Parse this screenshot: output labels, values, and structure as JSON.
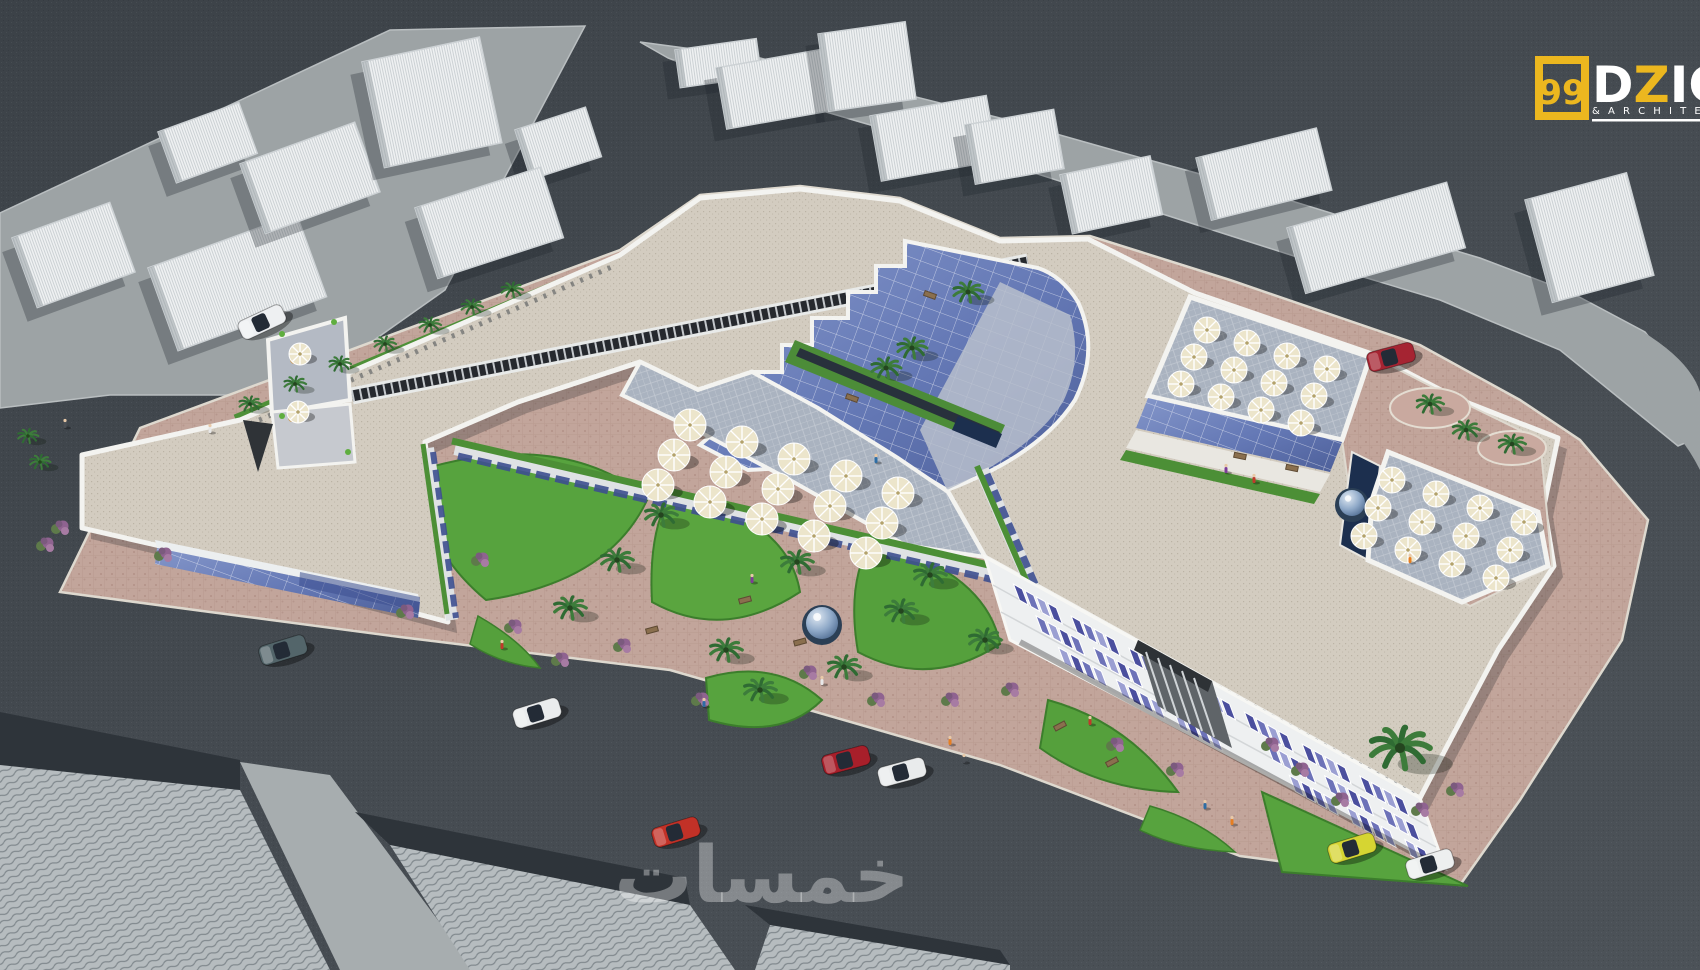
{
  "logo": {
    "number": "99",
    "name_white_1": "D",
    "name_yellow": "Z",
    "name_white_2": "IG",
    "subtitle": "& A R C H I T E",
    "yellow": "#ecb71f",
    "white": "#ffffff"
  },
  "watermark": {
    "text": "خمسات",
    "color": "rgba(255,255,255,0.34)"
  },
  "palette": {
    "road": "#454b51",
    "road_dark": "#383e44",
    "parcel": "#9da3a5",
    "site_paving": "#c2a59b",
    "roof": "#d3ccc0",
    "parapet": "#f3f3f0",
    "glass_hi": "#7d90c4",
    "glass_lo": "#55679f",
    "lawn": "#57a33e",
    "hedge": "#4c8f36",
    "pool": "#1c2f4e",
    "terrace_paving": "#aab3c0",
    "facade": "#eef0f1",
    "window_blue": "#4b4f9e",
    "umbrella": "#ece5cb",
    "skylight": "#23262b"
  },
  "scene": {
    "context_blocks_p1": [
      {
        "x": 12,
        "y": 238,
        "w": 104,
        "h": 74,
        "r": -20
      },
      {
        "x": 148,
        "y": 268,
        "w": 158,
        "h": 88,
        "r": -20
      },
      {
        "x": 158,
        "y": 132,
        "w": 86,
        "h": 54,
        "r": -20
      },
      {
        "x": 240,
        "y": 164,
        "w": 122,
        "h": 74,
        "r": -20
      },
      {
        "x": 362,
        "y": 62,
        "w": 120,
        "h": 108,
        "r": -12
      },
      {
        "x": 515,
        "y": 130,
        "w": 74,
        "h": 52,
        "r": -18
      },
      {
        "x": 415,
        "y": 208,
        "w": 132,
        "h": 74,
        "r": -18
      }
    ],
    "context_blocks_p2": [
      {
        "x": 675,
        "y": 50,
        "w": 82,
        "h": 38,
        "r": -8
      },
      {
        "x": 716,
        "y": 68,
        "w": 112,
        "h": 62,
        "r": -10
      },
      {
        "x": 818,
        "y": 34,
        "w": 88,
        "h": 78,
        "r": -8
      },
      {
        "x": 870,
        "y": 116,
        "w": 118,
        "h": 66,
        "r": -10
      },
      {
        "x": 965,
        "y": 125,
        "w": 90,
        "h": 60,
        "r": -10
      },
      {
        "x": 1060,
        "y": 175,
        "w": 92,
        "h": 60,
        "r": -12
      },
      {
        "x": 1196,
        "y": 158,
        "w": 124,
        "h": 64,
        "r": -14
      },
      {
        "x": 1287,
        "y": 228,
        "w": 166,
        "h": 68,
        "r": -16
      },
      {
        "x": 1525,
        "y": 200,
        "w": 105,
        "h": 106,
        "r": -15
      }
    ],
    "construction_blocks": [
      {
        "pts": "0,765 240,790 330,970 0,970",
        "shadow": "0,712 240,760 240,790 0,765"
      },
      {
        "pts": "390,845 690,905 735,970 470,970",
        "shadow": "355,812 685,878 690,905 390,845"
      },
      {
        "pts": "770,925 1010,965 1010,970 755,970",
        "shadow": "745,905 1000,950 1010,965 770,925"
      }
    ],
    "cars": [
      {
        "name": "white-car-parked-nw",
        "x": 262,
        "y": 322,
        "r": -25,
        "color": "#eef0f2"
      },
      {
        "name": "teal-sedan",
        "x": 283,
        "y": 650,
        "r": -17,
        "color": "#53656a"
      },
      {
        "name": "white-suv",
        "x": 537,
        "y": 713,
        "r": -17,
        "color": "#eaeced"
      },
      {
        "name": "red-hatchback",
        "x": 676,
        "y": 832,
        "r": -17,
        "color": "#c23127"
      },
      {
        "name": "red-sedan",
        "x": 846,
        "y": 760,
        "r": -15,
        "color": "#a81f2a"
      },
      {
        "name": "white-sedan",
        "x": 902,
        "y": 772,
        "r": -15,
        "color": "#e9ebec"
      },
      {
        "name": "red-car-parked-ne",
        "x": 1391,
        "y": 357,
        "r": -15,
        "color": "#a52432"
      },
      {
        "name": "yellow-car",
        "x": 1352,
        "y": 848,
        "r": -17,
        "color": "#d6d532"
      },
      {
        "name": "white-car-se",
        "x": 1430,
        "y": 864,
        "r": -17,
        "color": "#edefef"
      }
    ],
    "umbrella_clusters": [
      {
        "name": "central-terrace",
        "x": 690,
        "y": 425,
        "ux": 52,
        "uy": 17,
        "vx": -16,
        "vy": 30,
        "cols": 5,
        "rows": 3,
        "rad": 16
      },
      {
        "name": "upper-right-terrace",
        "x": 1207,
        "y": 330,
        "ux": 40,
        "uy": 13,
        "vx": -13,
        "vy": 27,
        "cols": 4,
        "rows": 3,
        "rad": 13
      },
      {
        "name": "lower-right-terrace",
        "x": 1392,
        "y": 480,
        "ux": 44,
        "uy": 14,
        "vx": -14,
        "vy": 28,
        "cols": 4,
        "rows": 3,
        "rad": 13
      },
      {
        "name": "left-wing-terrace",
        "x": 300,
        "y": 354,
        "ux": 0,
        "uy": 0,
        "vx": -2,
        "vy": 58,
        "cols": 1,
        "rows": 2,
        "rad": 11
      }
    ],
    "palms": {
      "sidewalk_nw": [
        [
          250,
          404
        ],
        [
          295,
          384
        ],
        [
          340,
          364
        ],
        [
          385,
          344
        ],
        [
          430,
          325
        ],
        [
          472,
          307
        ],
        [
          512,
          290
        ]
      ],
      "gardens": [
        [
          570,
          608
        ],
        [
          661,
          515
        ],
        [
          726,
          650
        ],
        [
          797,
          562
        ],
        [
          901,
          611
        ],
        [
          844,
          667
        ],
        [
          930,
          575
        ],
        [
          617,
          560
        ],
        [
          985,
          640
        ],
        [
          760,
          690
        ]
      ],
      "atrium": [
        [
          968,
          292
        ],
        [
          912,
          348
        ],
        [
          886,
          368
        ]
      ],
      "ne_planters": [
        [
          1430,
          404
        ],
        [
          1512,
          444
        ],
        [
          1466,
          430
        ]
      ],
      "se_big": [
        [
          1400,
          748
        ]
      ],
      "west_corner": [
        [
          28,
          436
        ],
        [
          40,
          462
        ]
      ]
    },
    "bushes": [
      [
        513,
        627
      ],
      [
        622,
        646
      ],
      [
        808,
        673
      ],
      [
        876,
        700
      ],
      [
        950,
        700
      ],
      [
        1010,
        690
      ],
      [
        1115,
        745
      ],
      [
        1175,
        770
      ],
      [
        480,
        560
      ],
      [
        560,
        660
      ],
      [
        700,
        700
      ],
      [
        45,
        545
      ],
      [
        60,
        528
      ],
      [
        1300,
        770
      ],
      [
        1340,
        800
      ],
      [
        1420,
        810
      ],
      [
        1270,
        745
      ],
      [
        163,
        555
      ],
      [
        405,
        612
      ],
      [
        1455,
        790
      ]
    ],
    "benches": [
      [
        745,
        600,
        -15
      ],
      [
        800,
        642,
        -15
      ],
      [
        652,
        630,
        -15
      ],
      [
        1060,
        726,
        -28
      ],
      [
        1112,
        762,
        -28
      ],
      [
        930,
        295,
        20
      ],
      [
        852,
        398,
        20
      ],
      [
        1240,
        456,
        12
      ],
      [
        1292,
        468,
        12
      ]
    ],
    "people": [
      [
        502,
        646
      ],
      [
        704,
        704
      ],
      [
        950,
        742
      ],
      [
        964,
        760
      ],
      [
        822,
        682
      ],
      [
        752,
        580
      ],
      [
        1090,
        722
      ],
      [
        1205,
        806
      ],
      [
        1232,
        822
      ],
      [
        65,
        425
      ],
      [
        210,
        430
      ],
      [
        1226,
        470
      ],
      [
        1254,
        480
      ],
      [
        876,
        460
      ],
      [
        1410,
        560
      ]
    ],
    "fountains": [
      [
        822,
        625,
        16
      ],
      [
        1352,
        505,
        13
      ]
    ],
    "facade_windows": {
      "rows": 3,
      "groups": 7,
      "panes": 4
    }
  }
}
